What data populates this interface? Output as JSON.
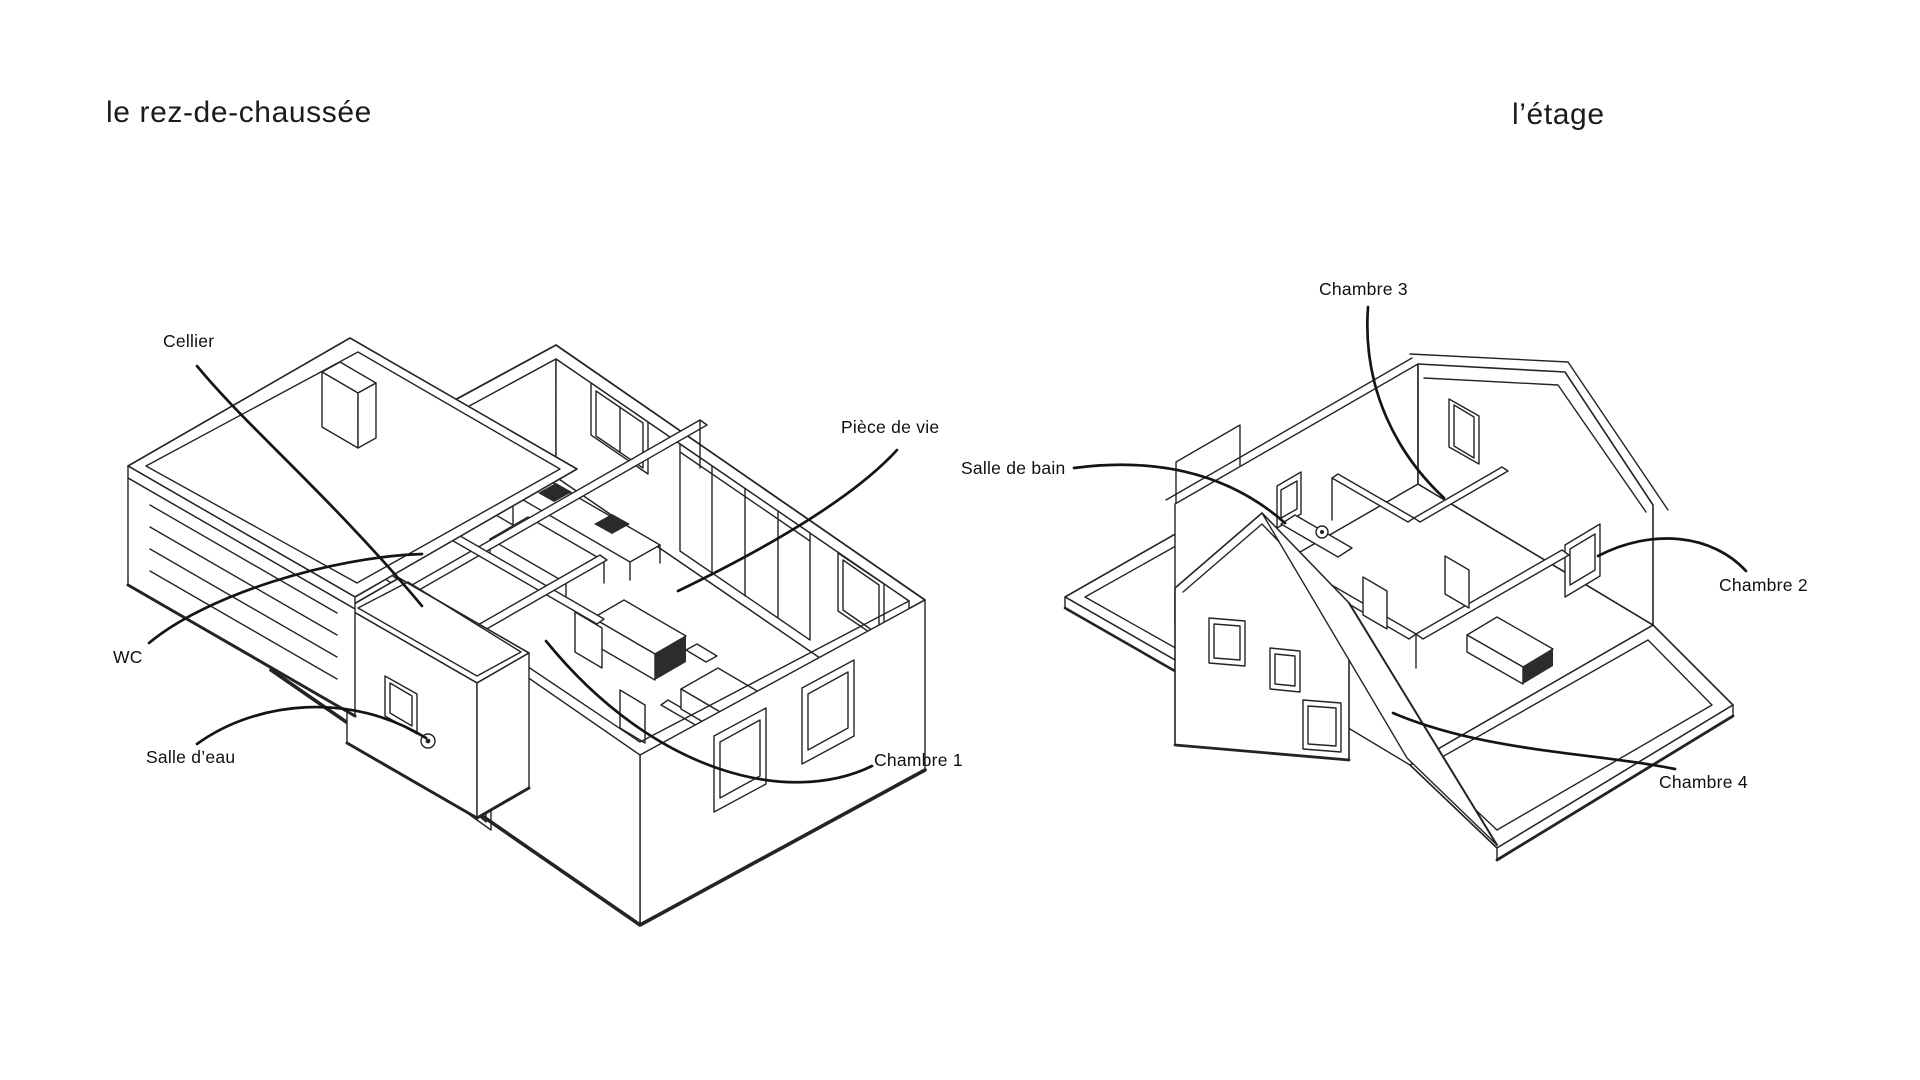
{
  "page": {
    "background": "#ffffff",
    "line_color": "#242424",
    "leader_color": "#141414",
    "label_color": "#101010"
  },
  "left_panel": {
    "title": "le rez-de-chaussée",
    "labels": [
      {
        "id": "cellier",
        "text": "Cellier"
      },
      {
        "id": "piece-de-vie",
        "text": "Pièce de vie"
      },
      {
        "id": "wc",
        "text": "WC"
      },
      {
        "id": "salle-deau",
        "text": "Salle d’eau"
      },
      {
        "id": "chambre-1",
        "text": "Chambre 1"
      }
    ]
  },
  "right_panel": {
    "title": "l’étage",
    "labels": [
      {
        "id": "chambre-3",
        "text": "Chambre 3"
      },
      {
        "id": "salle-de-bain",
        "text": "Salle de bain"
      },
      {
        "id": "chambre-2",
        "text": "Chambre 2"
      },
      {
        "id": "chambre-4",
        "text": "Chambre 4"
      }
    ]
  }
}
